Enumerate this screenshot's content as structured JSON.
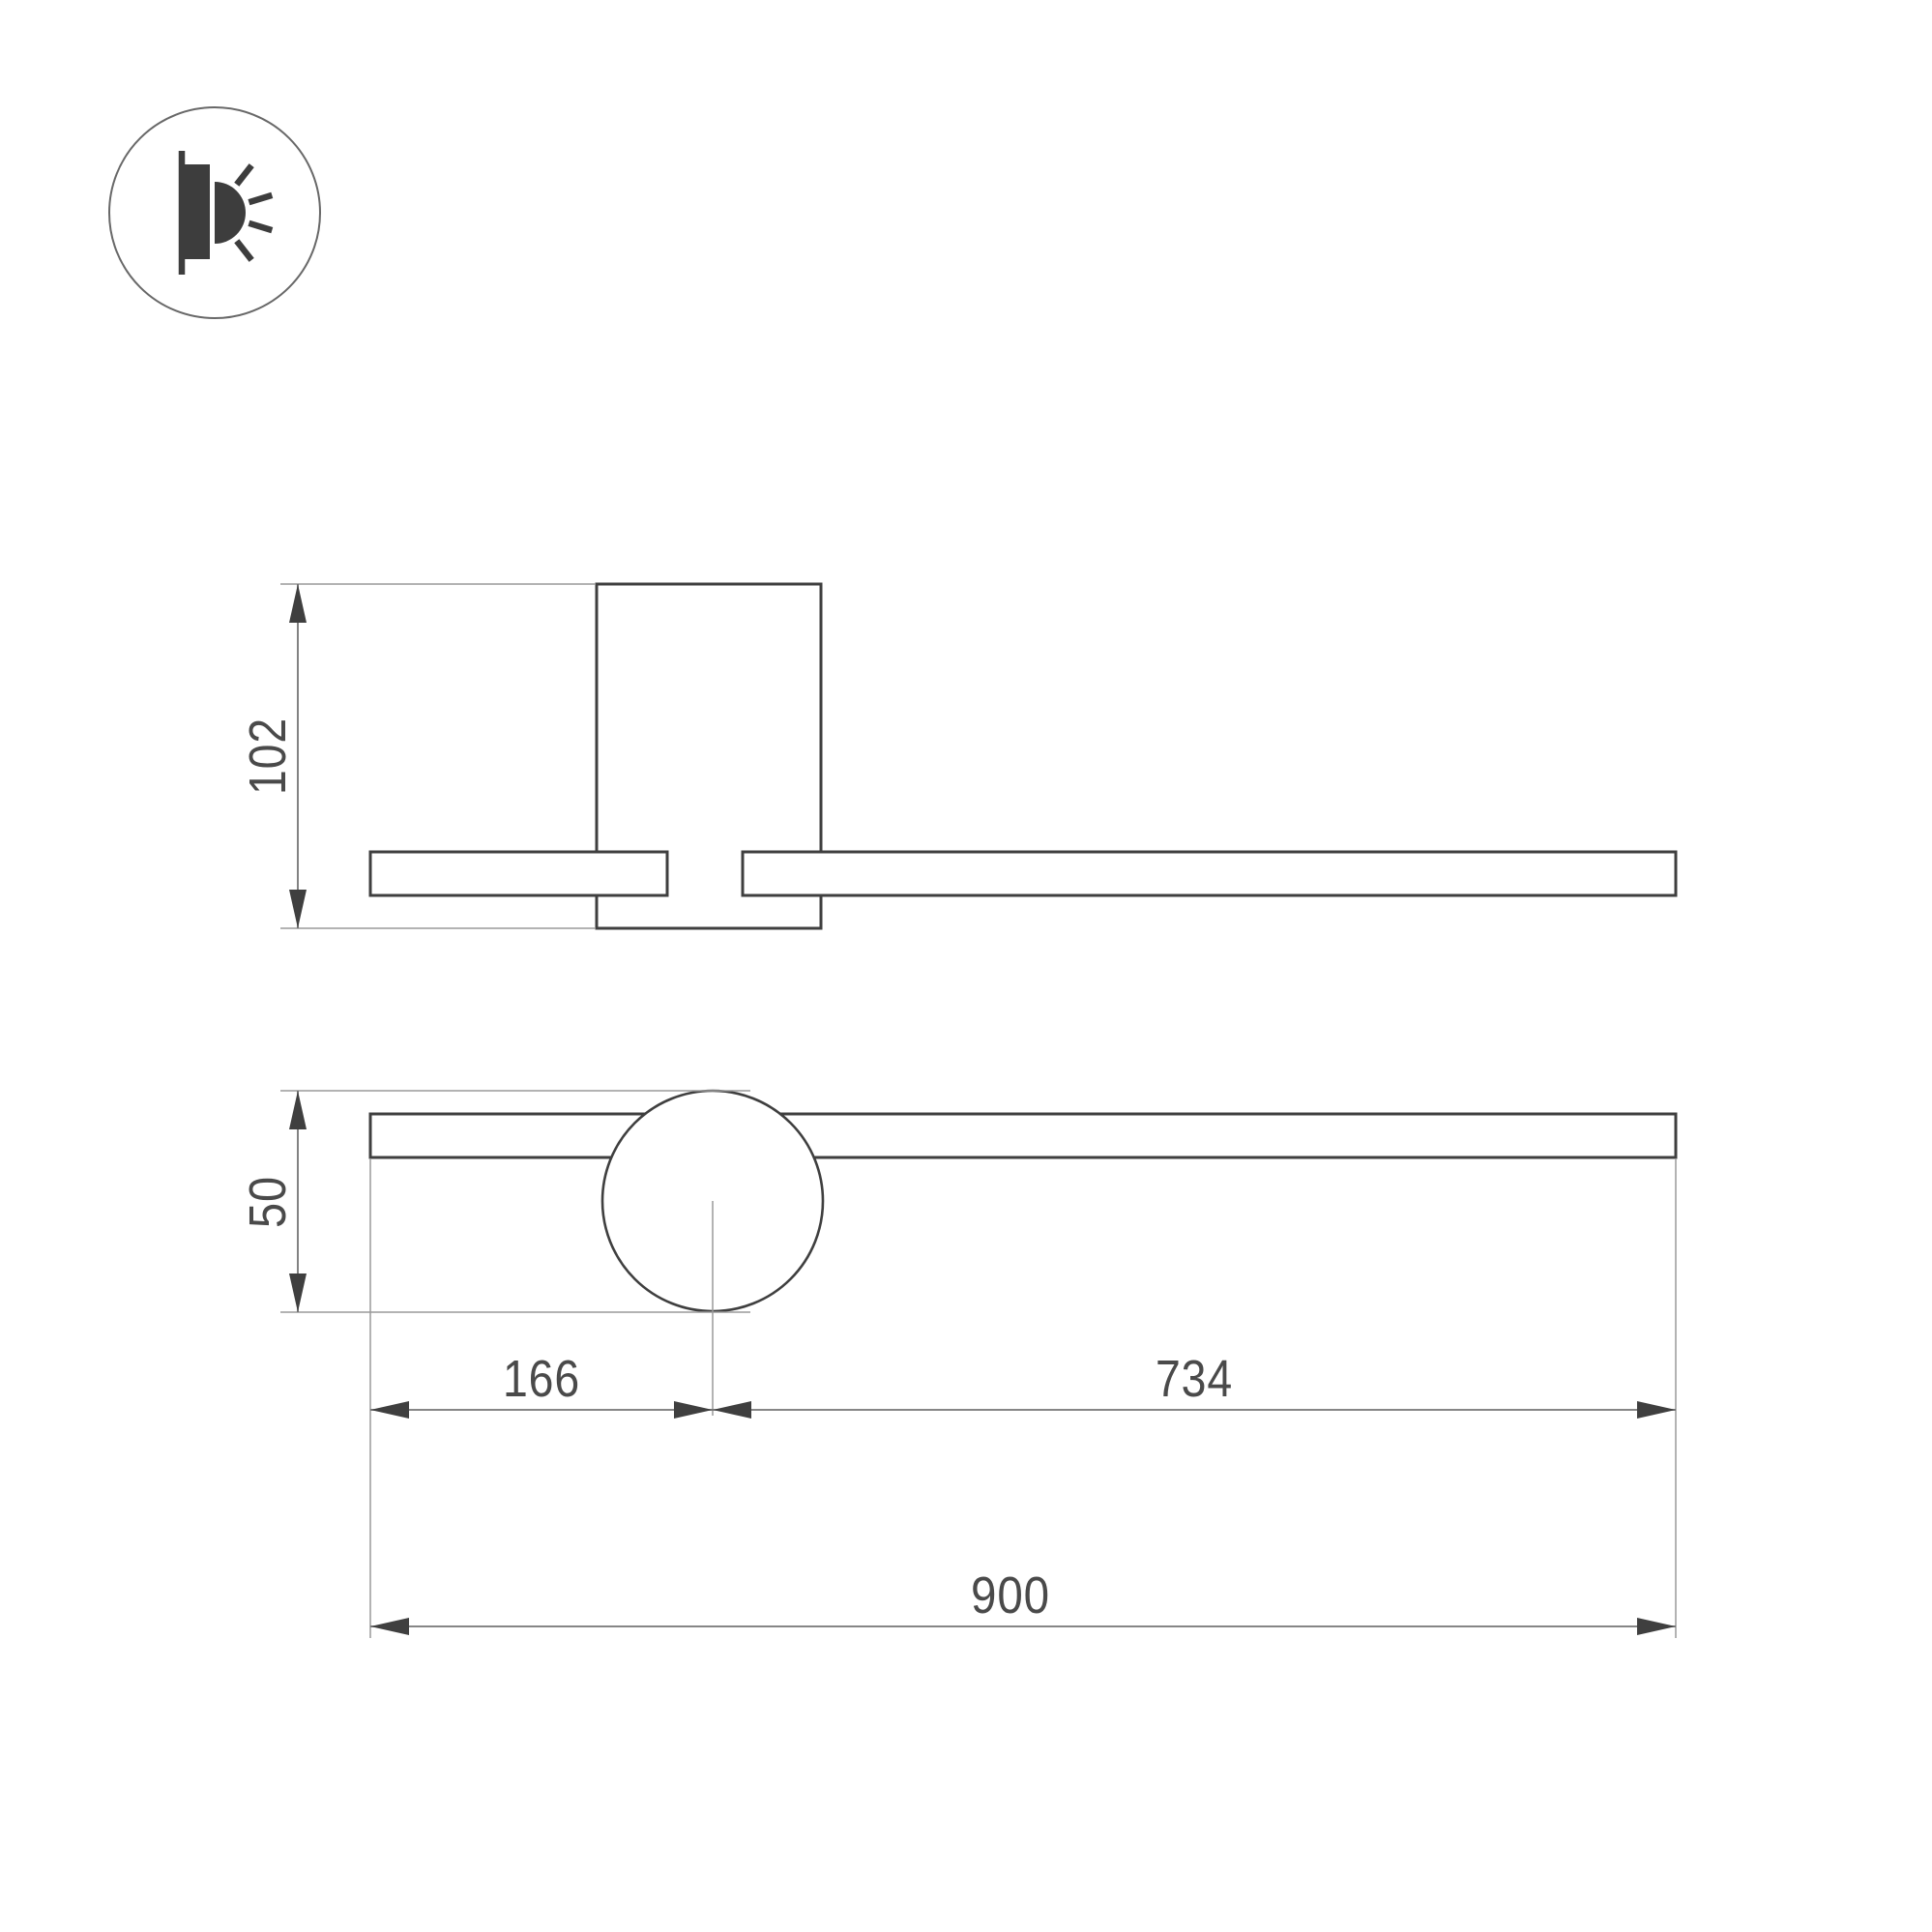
{
  "icon": {
    "name": "wall-mounted-light-icon",
    "description": "wall bracket light emitting sideways"
  },
  "dimensions": {
    "side_height": "102",
    "plate_diameter": "50",
    "offset_left": "166",
    "offset_right": "734",
    "total_length": "900"
  },
  "colors": {
    "background": "#ffffff",
    "outline": "#3f3f3f",
    "dimension_line": "#757575",
    "extension_line": "#9a9a9a",
    "text": "#4a4a4a",
    "icon_ring": "#686868"
  }
}
